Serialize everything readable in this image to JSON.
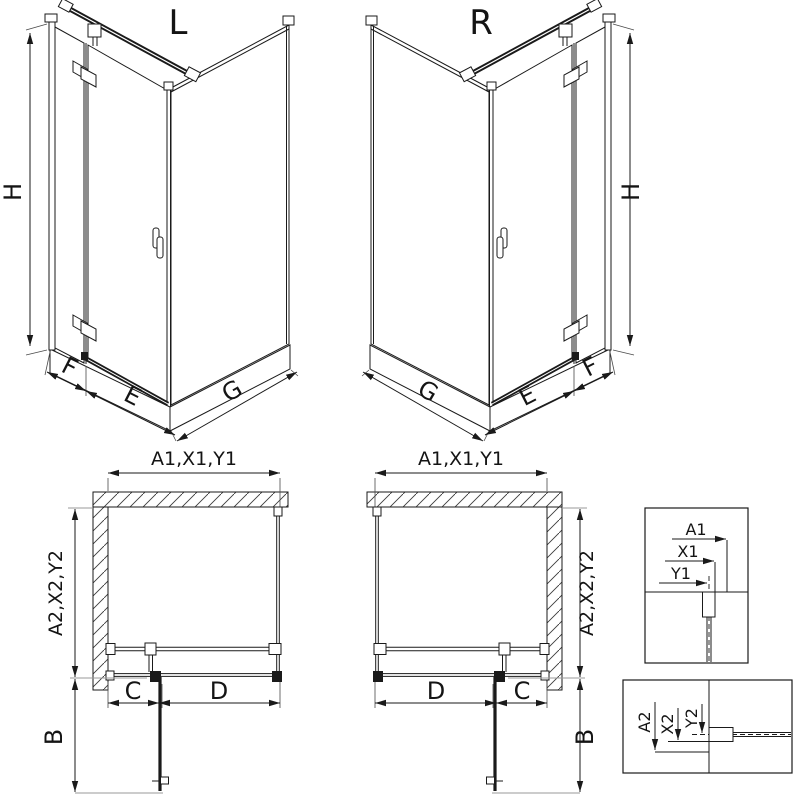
{
  "figure": {
    "kind": "shower-enclosure-dimension-diagram",
    "variants_shown": [
      "left-hinged (L)",
      "right-hinged (R)"
    ],
    "colors": {
      "line": "#1a1a1a",
      "extension_line": "#9a9a9a",
      "background": "#ffffff"
    }
  },
  "views": {
    "iso_left": {
      "label": "L",
      "height": "H",
      "fixed_panel": "F",
      "door": "E",
      "side_panel": "G"
    },
    "iso_right": {
      "label": "R",
      "height": "H",
      "fixed_panel": "F",
      "door": "E",
      "side_panel": "G"
    },
    "plan_left": {
      "width": "A1,X1,Y1",
      "depth": "A2,X2,Y2",
      "fixed_segment": "C",
      "door_segment": "D",
      "door_projection": "B"
    },
    "plan_right": {
      "width": "A1,X1,Y1",
      "depth": "A2,X2,Y2",
      "fixed_segment": "C",
      "door_segment": "D",
      "door_projection": "B"
    },
    "detail_top": {
      "a1": "A1",
      "x1": "X1",
      "y1": "Y1"
    },
    "detail_bottom": {
      "a2": "A2",
      "x2": "X2",
      "y2": "Y2"
    }
  }
}
